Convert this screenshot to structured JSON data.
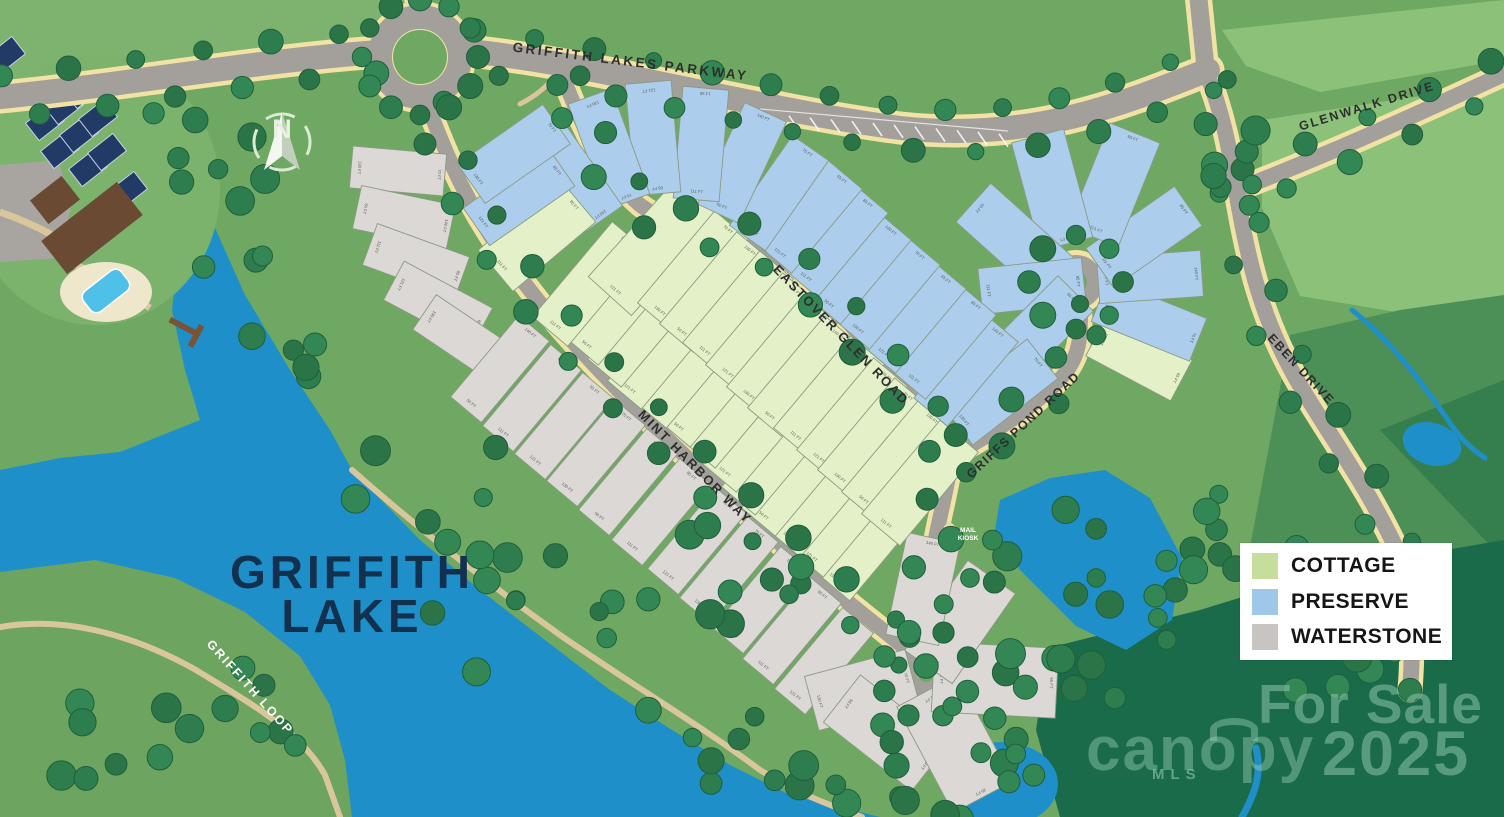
{
  "labels": {
    "lake_line1": "GRIFFITH",
    "lake_line2": "LAKE",
    "mail_kiosk_line1": "MAIL",
    "mail_kiosk_line2": "KIOSK",
    "compass_n": "N",
    "sq_ft": "SQ FT"
  },
  "roads": [
    {
      "id": "griffith-lakes-parkway",
      "label": "GRIFFITH LAKES PARKWAY"
    },
    {
      "id": "mint-harbor-way",
      "label": "MINT HARBOR WAY"
    },
    {
      "id": "eastover-glen-road",
      "label": "EASTOVER GLEN ROAD"
    },
    {
      "id": "griffs-pond-road",
      "label": "GRIFFS POND ROAD"
    },
    {
      "id": "glenwalk-drive",
      "label": "GLENWALK DRIVE"
    },
    {
      "id": "eben-drive",
      "label": "EBEN DRIVE"
    },
    {
      "id": "griffith-loop",
      "label": "GRIFFITH LOOP"
    }
  ],
  "legend": {
    "items": [
      {
        "label": "COTTAGE",
        "color": "#c6dd9b",
        "key": "cottage"
      },
      {
        "label": "PRESERVE",
        "color": "#9ec7ea",
        "key": "preserve"
      },
      {
        "label": "WATERSTONE",
        "color": "#c8c4c1",
        "key": "waterstone"
      }
    ]
  },
  "watermarks": {
    "for_sale": "For Sale",
    "year": "2025",
    "brand": "canopy",
    "brand_sub": "MLS"
  },
  "colors": {
    "base_green": "#6fa863",
    "light_field": "#8cc17a",
    "mid_field": "#4c9058",
    "dark_forest": "#1a6b4a",
    "water": "#1e8fc9",
    "road": "#a3a09b",
    "road_edge": "#f2e3a4",
    "trail": "#d9c69c",
    "cottage_fill": "#e4f0c8",
    "preserve_fill": "#accdec",
    "waterstone_fill": "#dcd8d5",
    "lot_line": "#8a9b80",
    "tree": "#2e7d4e",
    "lake_text": "#12314e"
  },
  "dimension_label_samples": [
    "130 FT",
    "70 FT",
    "50 FT",
    "140 FT",
    "111 FT",
    "85 FT",
    "121 FT",
    "65 FT"
  ],
  "lots": [
    {
      "number": "281",
      "sqft": "8,762",
      "community": "waterstone"
    },
    {
      "number": "282",
      "sqft": "10,300",
      "community": "waterstone"
    },
    {
      "number": "283",
      "sqft": "10,348",
      "community": "waterstone"
    },
    {
      "number": "284",
      "sqft": "10,348",
      "community": "waterstone"
    },
    {
      "number": "285",
      "sqft": "9,754",
      "community": "waterstone"
    },
    {
      "number": "286",
      "sqft": "9,100",
      "community": "waterstone"
    },
    {
      "number": "287",
      "sqft": "9,100",
      "community": "waterstone"
    },
    {
      "number": "288",
      "sqft": "9,100",
      "community": "waterstone"
    },
    {
      "number": "289",
      "sqft": "9,100",
      "community": "waterstone"
    },
    {
      "number": "290",
      "sqft": "9,100",
      "community": "waterstone"
    },
    {
      "number": "291",
      "sqft": "9,100",
      "community": "waterstone"
    },
    {
      "number": "292",
      "sqft": "9,100",
      "community": "waterstone"
    },
    {
      "number": "293",
      "sqft": "9,100",
      "community": "waterstone"
    },
    {
      "number": "294",
      "sqft": "9,425",
      "community": "waterstone"
    },
    {
      "number": "295",
      "sqft": "9,425",
      "community": "waterstone"
    },
    {
      "number": "296",
      "sqft": "9,100",
      "community": "waterstone"
    },
    {
      "number": "297",
      "sqft": "9,998",
      "community": "waterstone"
    },
    {
      "number": "298",
      "sqft": "12,269",
      "community": "waterstone"
    },
    {
      "number": "299",
      "sqft": "17,934",
      "community": "waterstone"
    },
    {
      "number": "300",
      "sqft": "17,934",
      "community": "waterstone"
    },
    {
      "number": "301",
      "sqft": "11,043",
      "community": "waterstone"
    },
    {
      "number": "302",
      "sqft": "10,639",
      "community": "waterstone"
    },
    {
      "number": "303",
      "sqft": "7,711",
      "community": "cottage"
    },
    {
      "number": "304",
      "sqft": "6,500",
      "community": "cottage"
    },
    {
      "number": "305",
      "sqft": "6,500",
      "community": "cottage"
    },
    {
      "number": "306",
      "sqft": "6,500",
      "community": "cottage"
    },
    {
      "number": "307",
      "sqft": "6,500",
      "community": "cottage"
    },
    {
      "number": "308",
      "sqft": "6,500",
      "community": "cottage"
    },
    {
      "number": "309",
      "sqft": "6,500",
      "community": "cottage"
    },
    {
      "number": "310",
      "sqft": "6,500",
      "community": "cottage"
    },
    {
      "number": "311",
      "sqft": "6,500",
      "community": "cottage"
    },
    {
      "number": "312",
      "sqft": "6,500",
      "community": "cottage"
    },
    {
      "number": "313",
      "sqft": "6,500",
      "community": "cottage"
    },
    {
      "number": "314",
      "sqft": "6,500",
      "community": "cottage"
    },
    {
      "number": "315",
      "sqft": "7,512",
      "community": "cottage"
    },
    {
      "number": "316",
      "sqft": "10,927",
      "community": "cottage"
    },
    {
      "number": "317",
      "sqft": "6,497",
      "community": "cottage"
    },
    {
      "number": "318",
      "sqft": "6,500",
      "community": "cottage"
    },
    {
      "number": "319",
      "sqft": "6,500",
      "community": "cottage"
    },
    {
      "number": "320",
      "sqft": "6,500",
      "community": "cottage"
    },
    {
      "number": "321",
      "sqft": "6,500",
      "community": "cottage"
    },
    {
      "number": "322",
      "sqft": "6,500",
      "community": "cottage"
    },
    {
      "number": "323",
      "sqft": "6,500",
      "community": "cottage"
    },
    {
      "number": "324",
      "sqft": "6,500",
      "community": "cottage"
    },
    {
      "number": "325",
      "sqft": "6,500",
      "community": "cottage"
    },
    {
      "number": "326",
      "sqft": "6,500",
      "community": "cottage"
    },
    {
      "number": "327",
      "sqft": "7,711",
      "community": "cottage"
    },
    {
      "number": "328",
      "sqft": "7,276",
      "community": "cottage"
    },
    {
      "number": "329",
      "sqft": "10,005",
      "community": "preserve"
    },
    {
      "number": "330",
      "sqft": "9,165",
      "community": "preserve"
    },
    {
      "number": "331",
      "sqft": "9,863",
      "community": "preserve"
    },
    {
      "number": "332",
      "sqft": "14,234",
      "community": "preserve"
    },
    {
      "number": "333",
      "sqft": "13,831",
      "community": "preserve"
    },
    {
      "number": "334",
      "sqft": "13,080",
      "community": "preserve"
    },
    {
      "number": "335",
      "sqft": "8,445",
      "community": "preserve"
    },
    {
      "number": "336",
      "sqft": "12,762",
      "community": "preserve"
    },
    {
      "number": "337",
      "sqft": "8,333",
      "community": "preserve"
    },
    {
      "number": "338",
      "sqft": "7,771",
      "community": "preserve"
    },
    {
      "number": "339",
      "sqft": "7,771",
      "community": "preserve"
    },
    {
      "number": "340",
      "sqft": "7,771",
      "community": "preserve"
    },
    {
      "number": "341",
      "sqft": "7,771",
      "community": "preserve"
    },
    {
      "number": "342",
      "sqft": "7,771",
      "community": "preserve"
    },
    {
      "number": "343",
      "sqft": "7,771",
      "community": "preserve"
    },
    {
      "number": "344",
      "sqft": "7,771",
      "community": "preserve"
    },
    {
      "number": "345",
      "sqft": "8,418",
      "community": "preserve"
    },
    {
      "number": "346",
      "sqft": "10,434",
      "community": "preserve"
    },
    {
      "number": "347",
      "sqft": "9,009",
      "community": "preserve"
    },
    {
      "number": "348",
      "sqft": "9,289",
      "community": "preserve"
    },
    {
      "number": "349",
      "sqft": "9,670",
      "community": "preserve"
    },
    {
      "number": "350",
      "sqft": "8,421",
      "community": "preserve"
    },
    {
      "number": "351",
      "sqft": "8,623",
      "community": "cottage"
    },
    {
      "number": "352",
      "sqft": "9,430",
      "community": "preserve"
    },
    {
      "number": "353",
      "sqft": "9,630",
      "community": "preserve"
    }
  ]
}
